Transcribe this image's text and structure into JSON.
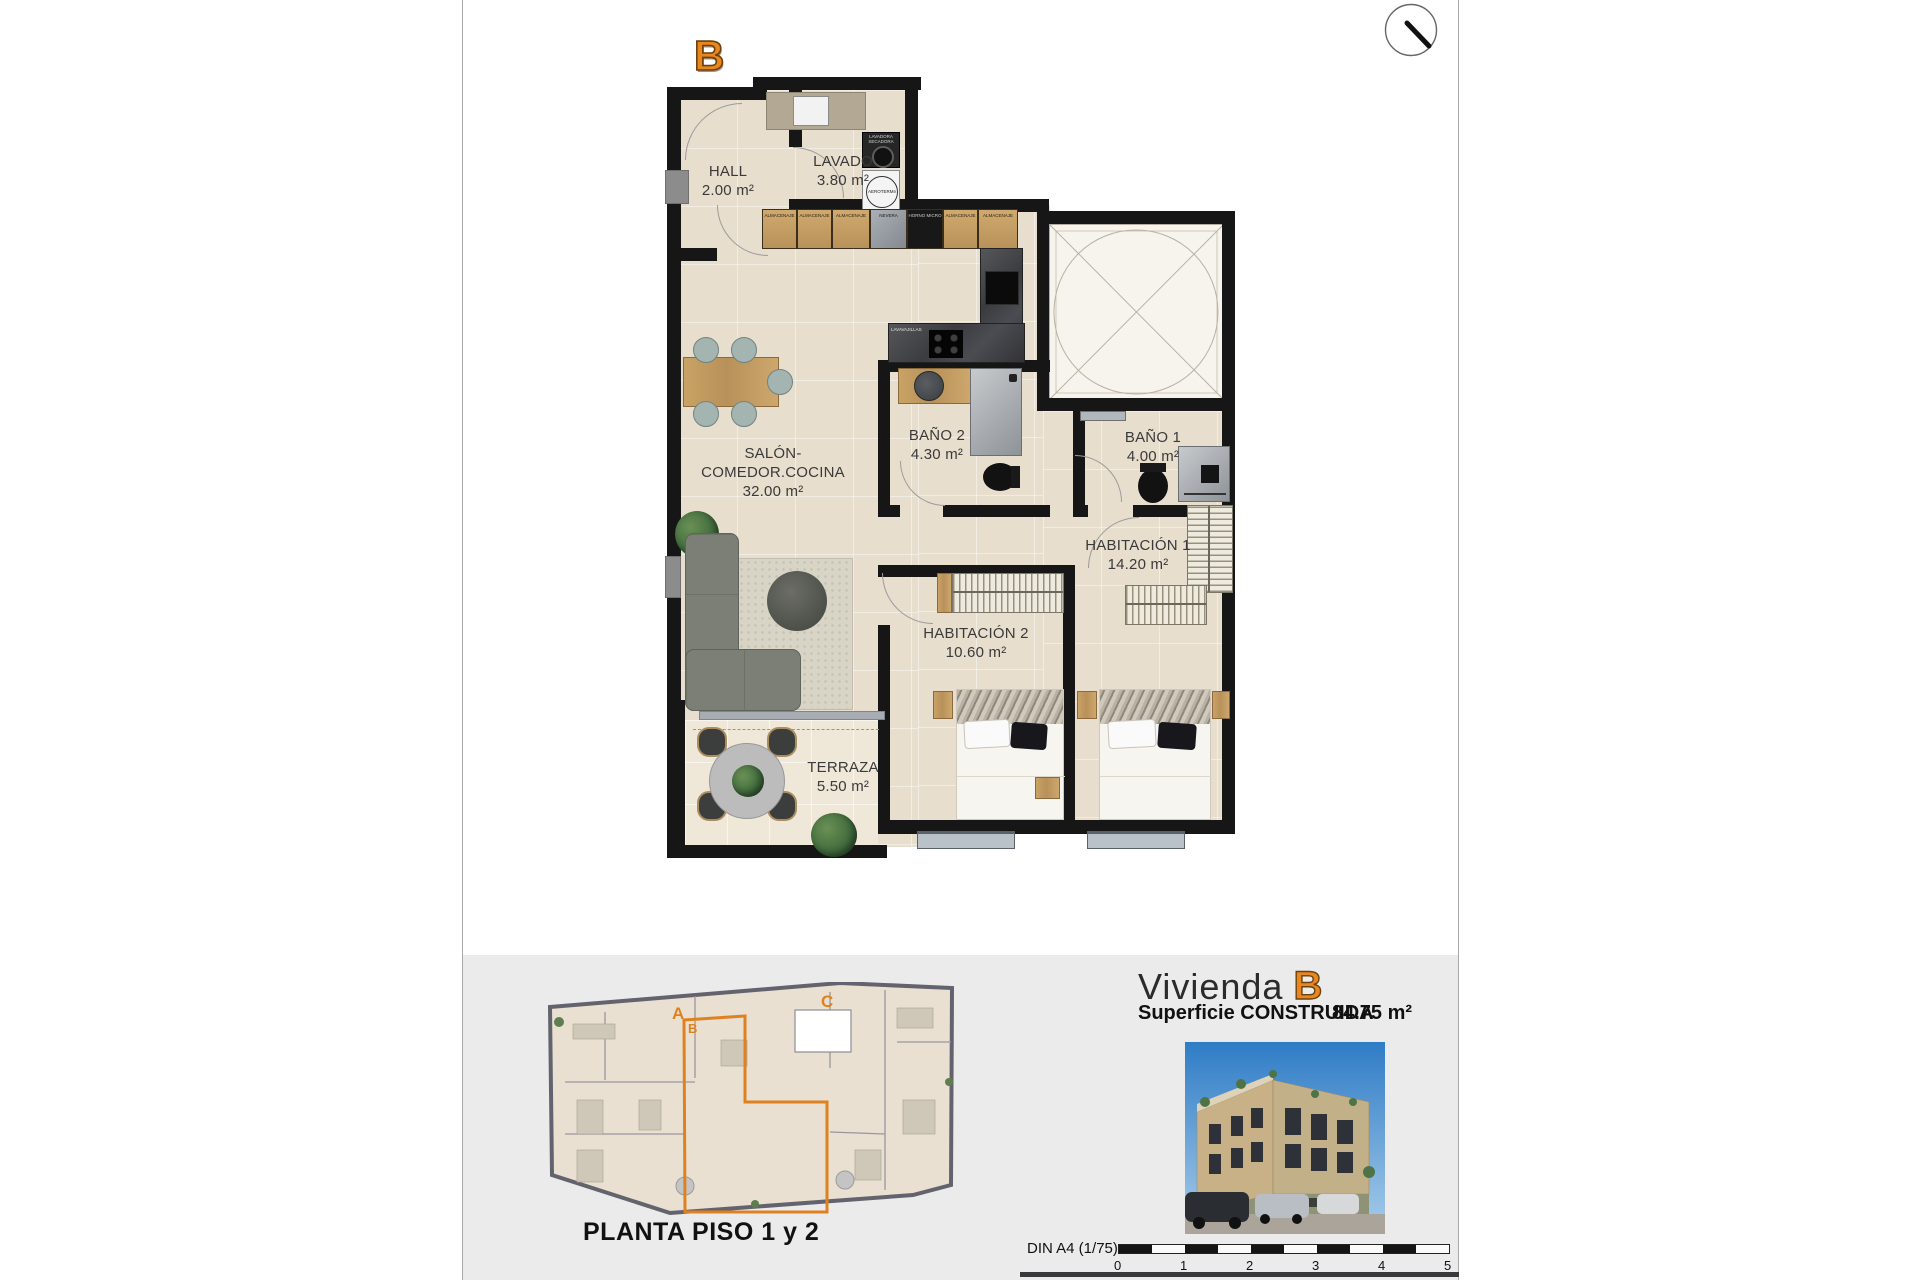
{
  "page": {
    "unit_letter_top": "B"
  },
  "plan": {
    "rooms": {
      "hall": {
        "name": "HALL",
        "area": "2.00 m²"
      },
      "lavado": {
        "name": "LAVADO",
        "area": "3.80 m²"
      },
      "salon": {
        "name": "SALÓN-COMEDOR.COCINA",
        "area": "32.00 m²"
      },
      "bano2": {
        "name": "BAÑO 2",
        "area": "4.30 m²"
      },
      "bano1": {
        "name": "BAÑO 1",
        "area": "4.00 m²"
      },
      "hab1": {
        "name": "HABITACIÓN 1",
        "area": "14.20 m²"
      },
      "hab2": {
        "name": "HABITACIÓN 2",
        "area": "10.60 m²"
      },
      "terraza": {
        "name": "TERRAZA",
        "area": "5.50 m²"
      }
    },
    "appliances": {
      "washer": "LAVADORA SECADORA",
      "aerotermia": "AEROTERMIA",
      "dishwasher": "LAVAVAJILLAS",
      "cabinets": [
        "ALMACENAJE",
        "ALMACENAJE",
        "ALMACENAJE",
        "NEVERA",
        "HORNO MICRO",
        "ALMACENAJE",
        "ALMACENAJE"
      ]
    }
  },
  "overview": {
    "title": "PLANTA PISO 1 y 2",
    "unit_a": "A",
    "unit_b": "B",
    "unit_c": "C"
  },
  "info": {
    "title_prefix": "Vivienda",
    "unit": "B",
    "surface_label": "Superficie CONSTRUIDA",
    "surface_value": "84.75 m²"
  },
  "scale": {
    "label": "DIN A4 (1/75)",
    "ticks": [
      "0",
      "1",
      "2",
      "3",
      "4",
      "5"
    ]
  },
  "colors": {
    "accent": "#e0811f",
    "wall": "#161616",
    "floor": "#e8decd",
    "footer_bg": "#ecebeb"
  }
}
